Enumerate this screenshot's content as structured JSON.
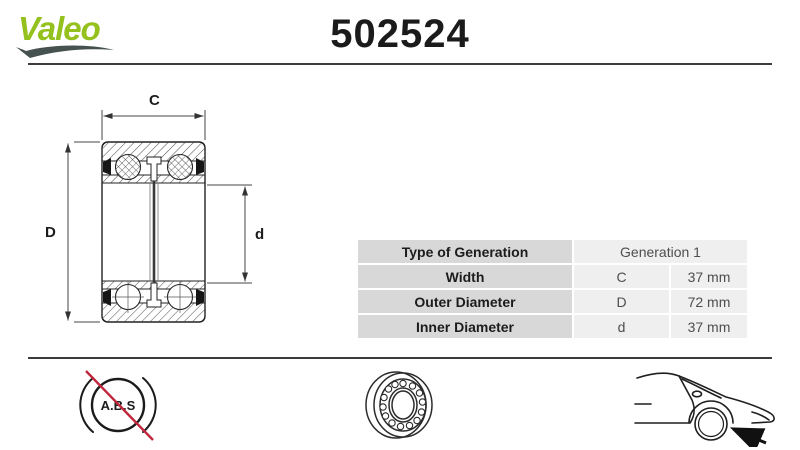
{
  "header": {
    "brand": "Valeo",
    "part_number": "502524"
  },
  "diagram": {
    "width_symbol": "C",
    "outer_symbol": "D",
    "inner_symbol": "d"
  },
  "spec_table": {
    "rows": [
      {
        "label": "Type of Generation",
        "symbol": "",
        "value": "Generation 1"
      },
      {
        "label": "Width",
        "symbol": "C",
        "value": "37 mm"
      },
      {
        "label": "Outer Diameter",
        "symbol": "D",
        "value": "72 mm"
      },
      {
        "label": "Inner Diameter",
        "symbol": "d",
        "value": "37 mm"
      }
    ]
  },
  "footer": {
    "abs_text": "A.B.S",
    "icons": [
      {
        "name": "abs-crossed-icon",
        "meaning": "without ABS sensor ring"
      },
      {
        "name": "bearing-icon",
        "meaning": "wheel bearing"
      },
      {
        "name": "car-front-wheel-icon",
        "meaning": "fits front wheel position"
      }
    ]
  },
  "colors": {
    "brand_green": "#94c11e",
    "swoosh_gray": "#46524f",
    "abs_red": "#c0273c",
    "table_label_bg": "#d8d8d8",
    "table_value_bg": "#efefef",
    "divider": "#3c3c3c"
  }
}
